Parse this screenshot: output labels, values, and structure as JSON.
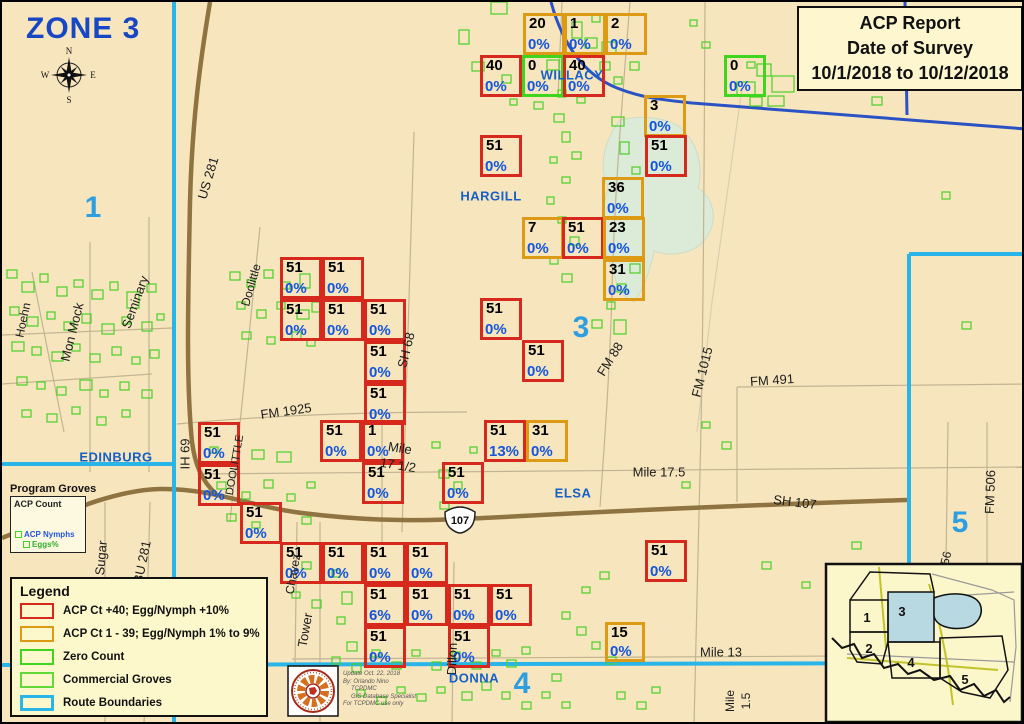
{
  "header": {
    "zone_title": "ZONE 3",
    "report_line1": "ACP Report",
    "report_line2": "Date of Survey",
    "report_line3": "10/1/2018 to 10/12/2018"
  },
  "compass": {
    "n": "N",
    "s": "S",
    "e": "E",
    "w": "W"
  },
  "shield": {
    "route": "107"
  },
  "legend": {
    "title": "Legend",
    "items": [
      {
        "label": "ACP Ct +40; Egg/Nymph +10%",
        "color": "#d6281c",
        "stroke": 2.5
      },
      {
        "label": "ACP Ct 1 - 39; Egg/Nymph 1% to 9%",
        "color": "#dd9a15",
        "stroke": 2.5
      },
      {
        "label": "Zero Count",
        "color": "#3fd41e",
        "stroke": 2.5
      },
      {
        "label": "Commercial Groves",
        "color": "#62d938",
        "stroke": 2
      },
      {
        "label": "Route Boundaries",
        "color": "#2ab5e8",
        "stroke": 3.5
      }
    ]
  },
  "program_groves": {
    "title": "Program Groves",
    "count_label": "ACP Count",
    "nymphs_label": "ACP Nymphs",
    "eggs_label": "Eggs%"
  },
  "credits": {
    "lines": [
      "Update Oct. 22, 2018",
      "By: Orlando Nino",
      "TCPDMC",
      "GIS Database Specialist",
      "For TCPDMC use only"
    ]
  },
  "map_colors": {
    "background": "#f7e6bd",
    "route_boundary_cyan": "#2ab5e8",
    "route_boundary_blue": "#2a52c4",
    "major_road_brown": "#8f7442",
    "grove_green": "#49d028",
    "lake": "#dcead8",
    "red_square": "#d6281c",
    "orange_square": "#dd9a15",
    "green_square": "#3fd41e",
    "percent_blue": "#1455e0"
  },
  "squares": [
    {
      "x": 521,
      "y": 11,
      "count": "20",
      "pct": "0%",
      "type": "orange"
    },
    {
      "x": 562,
      "y": 11,
      "count": "1",
      "pct": "0%",
      "type": "orange"
    },
    {
      "x": 603,
      "y": 11,
      "count": "2",
      "pct": "0%",
      "type": "orange"
    },
    {
      "x": 478,
      "y": 53,
      "count": "40",
      "pct": "0%",
      "type": "red"
    },
    {
      "x": 520,
      "y": 53,
      "count": "0",
      "pct": "0%",
      "type": "green"
    },
    {
      "x": 561,
      "y": 53,
      "count": "40",
      "pct": "0%",
      "type": "red"
    },
    {
      "x": 722,
      "y": 53,
      "count": "0",
      "pct": "0%",
      "type": "green"
    },
    {
      "x": 642,
      "y": 93,
      "count": "3",
      "pct": "0%",
      "type": "orange"
    },
    {
      "x": 643,
      "y": 133,
      "count": "51",
      "pct": "0%",
      "type": "red"
    },
    {
      "x": 478,
      "y": 133,
      "count": "51",
      "pct": "0%",
      "type": "red"
    },
    {
      "x": 600,
      "y": 175,
      "count": "36",
      "pct": "0%",
      "type": "orange"
    },
    {
      "x": 520,
      "y": 215,
      "count": "7",
      "pct": "0%",
      "type": "orange"
    },
    {
      "x": 560,
      "y": 215,
      "count": "51",
      "pct": "0%",
      "type": "red"
    },
    {
      "x": 601,
      "y": 215,
      "count": "23",
      "pct": "0%",
      "type": "orange"
    },
    {
      "x": 601,
      "y": 257,
      "count": "31",
      "pct": "0%",
      "type": "orange"
    },
    {
      "x": 478,
      "y": 296,
      "count": "51",
      "pct": "0%",
      "type": "red"
    },
    {
      "x": 520,
      "y": 338,
      "count": "51",
      "pct": "0%",
      "type": "red"
    },
    {
      "x": 278,
      "y": 255,
      "count": "51",
      "pct": "0%",
      "type": "red"
    },
    {
      "x": 320,
      "y": 255,
      "count": "51",
      "pct": "0%",
      "type": "red"
    },
    {
      "x": 278,
      "y": 297,
      "count": "51",
      "pct": "0%",
      "type": "red"
    },
    {
      "x": 320,
      "y": 297,
      "count": "51",
      "pct": "0%",
      "type": "red"
    },
    {
      "x": 362,
      "y": 297,
      "count": "51",
      "pct": "0%",
      "type": "red"
    },
    {
      "x": 362,
      "y": 339,
      "count": "51",
      "pct": "0%",
      "type": "red"
    },
    {
      "x": 362,
      "y": 381,
      "count": "51",
      "pct": "0%",
      "type": "red"
    },
    {
      "x": 196,
      "y": 420,
      "count": "51",
      "pct": "0%",
      "type": "red"
    },
    {
      "x": 196,
      "y": 462,
      "count": "51",
      "pct": "0%",
      "type": "red"
    },
    {
      "x": 238,
      "y": 500,
      "count": "51",
      "pct": "0%",
      "type": "red"
    },
    {
      "x": 318,
      "y": 418,
      "count": "51",
      "pct": "0%",
      "type": "red"
    },
    {
      "x": 360,
      "y": 418,
      "count": "1",
      "pct": "0%",
      "type": "red"
    },
    {
      "x": 360,
      "y": 460,
      "count": "51",
      "pct": "0%",
      "type": "red"
    },
    {
      "x": 440,
      "y": 460,
      "count": "51",
      "pct": "0%",
      "type": "red"
    },
    {
      "x": 482,
      "y": 418,
      "count": "51",
      "pct": "13%",
      "type": "red"
    },
    {
      "x": 524,
      "y": 418,
      "count": "31",
      "pct": "0%",
      "type": "orange"
    },
    {
      "x": 643,
      "y": 538,
      "count": "51",
      "pct": "0%",
      "type": "red"
    },
    {
      "x": 278,
      "y": 540,
      "count": "51",
      "pct": "0%",
      "type": "red"
    },
    {
      "x": 320,
      "y": 540,
      "count": "51",
      "pct": "0%",
      "type": "red"
    },
    {
      "x": 362,
      "y": 540,
      "count": "51",
      "pct": "0%",
      "type": "red"
    },
    {
      "x": 404,
      "y": 540,
      "count": "51",
      "pct": "0%",
      "type": "red"
    },
    {
      "x": 362,
      "y": 582,
      "count": "51",
      "pct": "6%",
      "type": "red"
    },
    {
      "x": 404,
      "y": 582,
      "count": "51",
      "pct": "0%",
      "type": "red"
    },
    {
      "x": 446,
      "y": 582,
      "count": "51",
      "pct": "0%",
      "type": "red"
    },
    {
      "x": 488,
      "y": 582,
      "count": "51",
      "pct": "0%",
      "type": "red"
    },
    {
      "x": 362,
      "y": 624,
      "count": "51",
      "pct": "0%",
      "type": "red"
    },
    {
      "x": 446,
      "y": 624,
      "count": "51",
      "pct": "0%",
      "type": "red"
    },
    {
      "x": 603,
      "y": 620,
      "count": "15",
      "pct": "0%",
      "type": "orange",
      "size": 40
    }
  ],
  "labels": {
    "places": [
      {
        "text": "WILLACY",
        "x": 570,
        "y": 73
      },
      {
        "text": "HARGILL",
        "x": 489,
        "y": 194
      },
      {
        "text": "EDINBURG",
        "x": 114,
        "y": 455
      },
      {
        "text": "ELSA",
        "x": 571,
        "y": 491
      },
      {
        "text": "DONNA",
        "x": 472,
        "y": 676
      }
    ],
    "zones": [
      {
        "text": "1",
        "x": 91,
        "y": 206
      },
      {
        "text": "3",
        "x": 579,
        "y": 326
      },
      {
        "text": "4",
        "x": 520,
        "y": 682
      },
      {
        "text": "5",
        "x": 958,
        "y": 521
      }
    ],
    "roads": [
      {
        "text": "US 281",
        "x": 206,
        "y": 176,
        "rot": -73
      },
      {
        "text": "IH 69",
        "x": 183,
        "y": 452,
        "rot": -90
      },
      {
        "text": "BU 281",
        "x": 140,
        "y": 560,
        "rot": -78
      },
      {
        "text": "Sugar",
        "x": 99,
        "y": 556,
        "rot": -85
      },
      {
        "text": "Seminary",
        "x": 133,
        "y": 300,
        "rot": -70
      },
      {
        "text": "Mon Mock",
        "x": 70,
        "y": 330,
        "rot": -76
      },
      {
        "text": "Hoehn",
        "x": 21,
        "y": 318,
        "rot": -78,
        "size": 12
      },
      {
        "text": "Doolittle",
        "x": 249,
        "y": 283,
        "rot": -74,
        "size": 12
      },
      {
        "text": "DOOLITTLE",
        "x": 233,
        "y": 463,
        "rot": -80,
        "size": 11
      },
      {
        "text": "FM 1925",
        "x": 284,
        "y": 409,
        "rot": -8
      },
      {
        "text": "SH 68",
        "x": 404,
        "y": 348,
        "rot": -76
      },
      {
        "text": "FM 88",
        "x": 608,
        "y": 357,
        "rot": -58
      },
      {
        "text": "FM 1015",
        "x": 700,
        "y": 370,
        "rot": -76
      },
      {
        "text": "FM 491",
        "x": 770,
        "y": 378,
        "rot": -4
      },
      {
        "text": "FM 506",
        "x": 988,
        "y": 490,
        "rot": -88
      },
      {
        "text": "56",
        "x": 944,
        "y": 556,
        "rot": -76,
        "size": 12
      },
      {
        "text": "SH 107",
        "x": 793,
        "y": 500,
        "rot": 7
      },
      {
        "text": "Mile 17.5",
        "x": 657,
        "y": 470,
        "rot": 0
      },
      {
        "text": "Mile",
        "x": 398,
        "y": 446,
        "rot": 9
      },
      {
        "text": "17 1/2",
        "x": 396,
        "y": 463,
        "rot": 9
      },
      {
        "text": "Mile 13",
        "x": 719,
        "y": 650,
        "rot": 0
      },
      {
        "text": "Mile",
        "x": 728,
        "y": 699,
        "rot": -90,
        "size": 12
      },
      {
        "text": "1.5",
        "x": 744,
        "y": 699,
        "rot": -90,
        "size": 12
      },
      {
        "text": "Tower",
        "x": 303,
        "y": 628,
        "rot": -80
      },
      {
        "text": "Dillon",
        "x": 450,
        "y": 657,
        "rot": -88
      },
      {
        "text": "Chavez",
        "x": 291,
        "y": 572,
        "rot": -80,
        "size": 12
      }
    ]
  },
  "inset": {
    "zone_labels": [
      {
        "text": "1",
        "x": 865,
        "y": 620
      },
      {
        "text": "2",
        "x": 867,
        "y": 651
      },
      {
        "text": "3",
        "x": 900,
        "y": 614
      },
      {
        "text": "4",
        "x": 909,
        "y": 665
      },
      {
        "text": "5",
        "x": 963,
        "y": 682
      }
    ]
  },
  "groves": [
    [
      489,
      0,
      16,
      12
    ],
    [
      457,
      28,
      10,
      14
    ],
    [
      470,
      60,
      12,
      9
    ],
    [
      500,
      73,
      9,
      8
    ],
    [
      508,
      97,
      7,
      6
    ],
    [
      532,
      100,
      9,
      7
    ],
    [
      545,
      58,
      12,
      10
    ],
    [
      556,
      88,
      8,
      7
    ],
    [
      570,
      20,
      10,
      16
    ],
    [
      583,
      36,
      12,
      10
    ],
    [
      590,
      12,
      8,
      8
    ],
    [
      600,
      40,
      14,
      12
    ],
    [
      598,
      60,
      10,
      8
    ],
    [
      612,
      75,
      8,
      7
    ],
    [
      628,
      60,
      9,
      8
    ],
    [
      575,
      95,
      8,
      6
    ],
    [
      700,
      40,
      8,
      6
    ],
    [
      688,
      18,
      7,
      6
    ],
    [
      735,
      80,
      18,
      14
    ],
    [
      755,
      62,
      14,
      12
    ],
    [
      770,
      74,
      22,
      16
    ],
    [
      748,
      95,
      12,
      9
    ],
    [
      766,
      94,
      16,
      10
    ],
    [
      745,
      60,
      8,
      6
    ],
    [
      870,
      95,
      10,
      8
    ],
    [
      552,
      112,
      10,
      8
    ],
    [
      560,
      130,
      8,
      10
    ],
    [
      548,
      155,
      7,
      6
    ],
    [
      570,
      150,
      9,
      7
    ],
    [
      560,
      175,
      8,
      6
    ],
    [
      545,
      195,
      7,
      7
    ],
    [
      556,
      215,
      8,
      6
    ],
    [
      568,
      235,
      9,
      8
    ],
    [
      548,
      255,
      8,
      7
    ],
    [
      560,
      272,
      10,
      8
    ],
    [
      610,
      115,
      12,
      9
    ],
    [
      618,
      140,
      9,
      12
    ],
    [
      630,
      165,
      8,
      7
    ],
    [
      615,
      282,
      9,
      8
    ],
    [
      628,
      262,
      10,
      9
    ],
    [
      605,
      300,
      8,
      7
    ],
    [
      590,
      318,
      10,
      8
    ],
    [
      612,
      318,
      12,
      14
    ],
    [
      5,
      268,
      10,
      8
    ],
    [
      20,
      280,
      12,
      10
    ],
    [
      38,
      272,
      8,
      8
    ],
    [
      55,
      285,
      10,
      9
    ],
    [
      72,
      278,
      9,
      7
    ],
    [
      90,
      288,
      11,
      9
    ],
    [
      108,
      280,
      8,
      8
    ],
    [
      125,
      290,
      12,
      16
    ],
    [
      145,
      282,
      9,
      8
    ],
    [
      8,
      305,
      9,
      8
    ],
    [
      25,
      315,
      11,
      9
    ],
    [
      45,
      310,
      8,
      7
    ],
    [
      62,
      320,
      10,
      8
    ],
    [
      80,
      312,
      9,
      9
    ],
    [
      100,
      322,
      12,
      10
    ],
    [
      120,
      315,
      8,
      7
    ],
    [
      140,
      320,
      10,
      9
    ],
    [
      155,
      312,
      7,
      6
    ],
    [
      10,
      340,
      12,
      9
    ],
    [
      30,
      345,
      9,
      8
    ],
    [
      50,
      350,
      11,
      9
    ],
    [
      70,
      342,
      8,
      7
    ],
    [
      88,
      352,
      10,
      8
    ],
    [
      110,
      345,
      9,
      8
    ],
    [
      130,
      355,
      8,
      7
    ],
    [
      148,
      348,
      9,
      8
    ],
    [
      15,
      375,
      10,
      8
    ],
    [
      35,
      380,
      8,
      7
    ],
    [
      55,
      385,
      9,
      8
    ],
    [
      78,
      378,
      12,
      10
    ],
    [
      98,
      388,
      8,
      7
    ],
    [
      118,
      380,
      9,
      8
    ],
    [
      140,
      388,
      10,
      8
    ],
    [
      20,
      408,
      9,
      7
    ],
    [
      45,
      412,
      10,
      8
    ],
    [
      70,
      405,
      8,
      7
    ],
    [
      95,
      415,
      9,
      8
    ],
    [
      120,
      408,
      8,
      7
    ],
    [
      228,
      270,
      10,
      8
    ],
    [
      245,
      278,
      8,
      7
    ],
    [
      262,
      268,
      9,
      8
    ],
    [
      280,
      280,
      8,
      7
    ],
    [
      298,
      272,
      10,
      14
    ],
    [
      235,
      300,
      8,
      7
    ],
    [
      255,
      308,
      9,
      8
    ],
    [
      275,
      300,
      8,
      7
    ],
    [
      295,
      308,
      12,
      9
    ],
    [
      240,
      330,
      9,
      7
    ],
    [
      265,
      335,
      8,
      7
    ],
    [
      290,
      330,
      9,
      8
    ],
    [
      310,
      300,
      8,
      10
    ],
    [
      305,
      338,
      8,
      6
    ],
    [
      437,
      468,
      10,
      8
    ],
    [
      452,
      480,
      8,
      7
    ],
    [
      438,
      500,
      9,
      7
    ],
    [
      462,
      512,
      8,
      6
    ],
    [
      430,
      440,
      8,
      6
    ],
    [
      468,
      445,
      7,
      6
    ],
    [
      215,
      480,
      9,
      7
    ],
    [
      240,
      490,
      8,
      7
    ],
    [
      262,
      478,
      9,
      8
    ],
    [
      285,
      492,
      8,
      7
    ],
    [
      305,
      480,
      8,
      6
    ],
    [
      225,
      512,
      9,
      7
    ],
    [
      250,
      520,
      8,
      6
    ],
    [
      300,
      515,
      9,
      7
    ],
    [
      208,
      445,
      8,
      6
    ],
    [
      250,
      448,
      12,
      9
    ],
    [
      275,
      450,
      14,
      10
    ],
    [
      300,
      560,
      9,
      7
    ],
    [
      330,
      568,
      8,
      7
    ],
    [
      290,
      590,
      8,
      6
    ],
    [
      310,
      598,
      9,
      8
    ],
    [
      340,
      590,
      10,
      12
    ],
    [
      335,
      615,
      8,
      7
    ],
    [
      345,
      640,
      10,
      9
    ],
    [
      330,
      655,
      8,
      7
    ],
    [
      350,
      662,
      9,
      8
    ],
    [
      370,
      648,
      8,
      7
    ],
    [
      390,
      660,
      9,
      7
    ],
    [
      410,
      648,
      8,
      6
    ],
    [
      430,
      660,
      9,
      8
    ],
    [
      450,
      650,
      8,
      7
    ],
    [
      470,
      660,
      9,
      7
    ],
    [
      490,
      648,
      8,
      6
    ],
    [
      505,
      658,
      9,
      7
    ],
    [
      520,
      645,
      8,
      7
    ],
    [
      480,
      680,
      9,
      8
    ],
    [
      500,
      690,
      8,
      7
    ],
    [
      460,
      690,
      10,
      8
    ],
    [
      435,
      685,
      8,
      6
    ],
    [
      415,
      692,
      9,
      7
    ],
    [
      395,
      685,
      8,
      6
    ],
    [
      375,
      695,
      9,
      7
    ],
    [
      355,
      688,
      8,
      6
    ],
    [
      310,
      680,
      14,
      10
    ],
    [
      520,
      700,
      9,
      7
    ],
    [
      540,
      690,
      8,
      6
    ],
    [
      550,
      672,
      9,
      7
    ],
    [
      560,
      610,
      8,
      7
    ],
    [
      575,
      625,
      9,
      8
    ],
    [
      590,
      640,
      8,
      7
    ],
    [
      605,
      655,
      9,
      7
    ],
    [
      580,
      585,
      8,
      6
    ],
    [
      598,
      570,
      9,
      7
    ],
    [
      615,
      690,
      8,
      7
    ],
    [
      635,
      700,
      9,
      7
    ],
    [
      650,
      685,
      8,
      6
    ],
    [
      560,
      700,
      8,
      6
    ],
    [
      940,
      190,
      8,
      7
    ],
    [
      960,
      320,
      9,
      7
    ],
    [
      700,
      420,
      8,
      6
    ],
    [
      720,
      440,
      9,
      7
    ],
    [
      680,
      480,
      8,
      6
    ],
    [
      760,
      560,
      9,
      7
    ],
    [
      800,
      580,
      8,
      6
    ],
    [
      850,
      540,
      9,
      7
    ]
  ]
}
